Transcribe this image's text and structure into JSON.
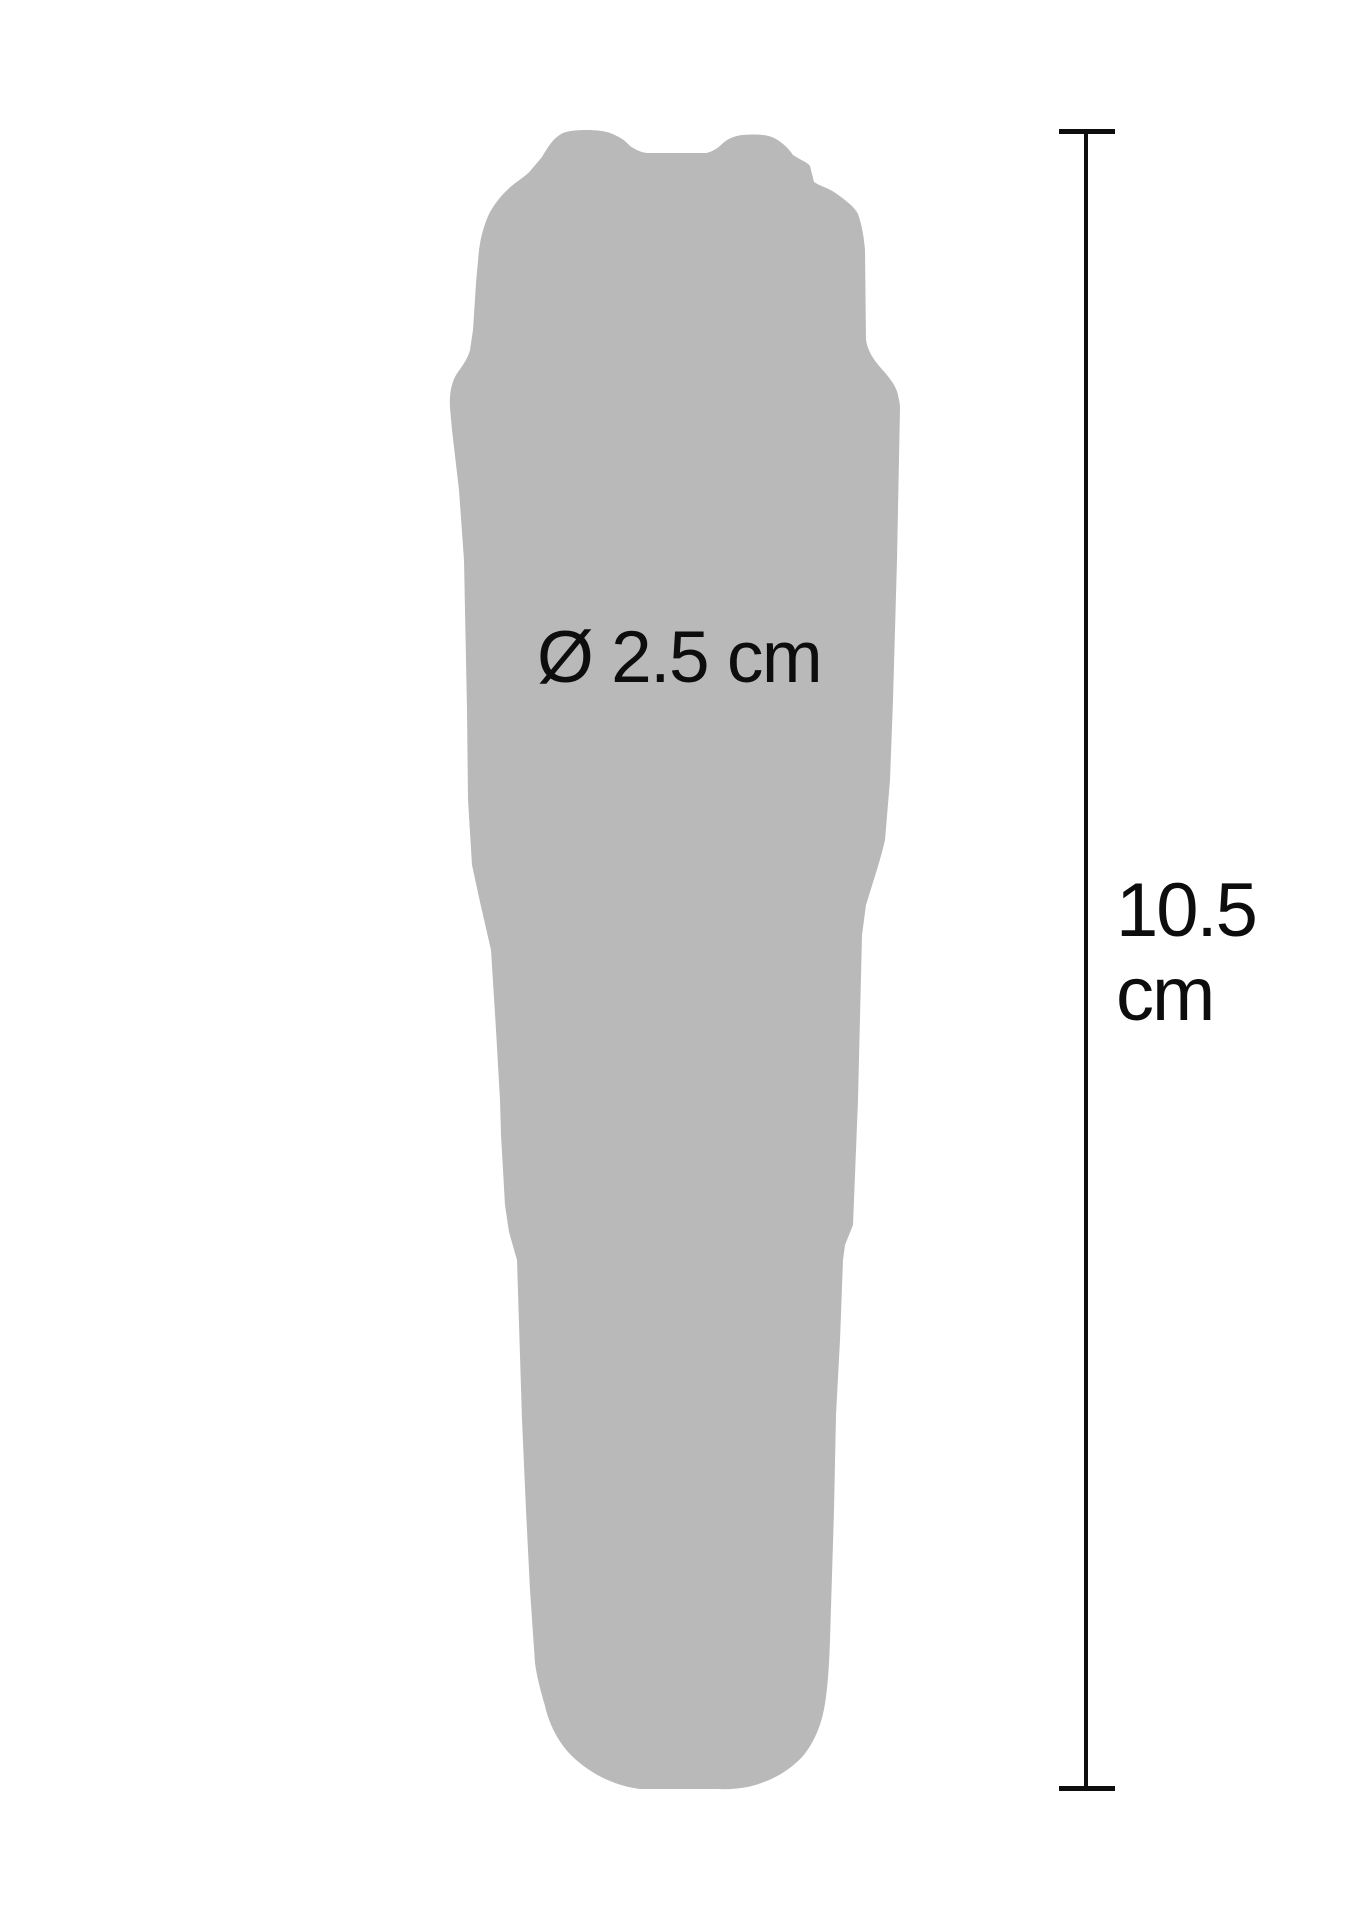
{
  "colors": {
    "background": "#ffffff",
    "silhouette": "#b9b9b9",
    "annotation": "#0d0d0d"
  },
  "labels": {
    "diameter": "Ø 2.5 cm",
    "height_value": "10.5",
    "height_unit": "cm"
  },
  "measurements": {
    "diameter": "2.5 cm",
    "height": "10.5 cm"
  }
}
